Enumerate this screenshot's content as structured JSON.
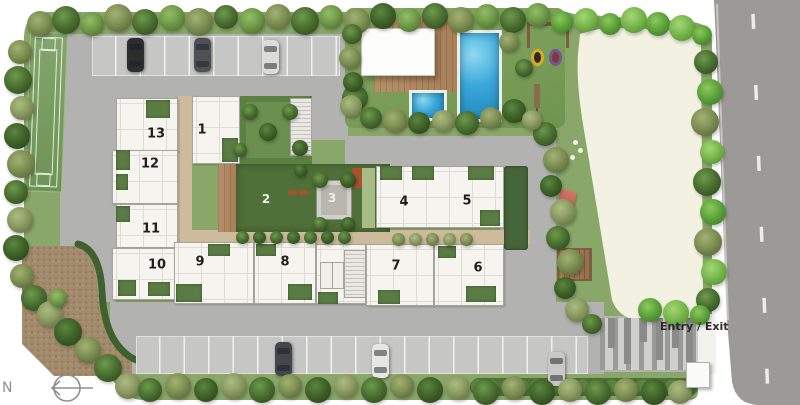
{
  "plan": {
    "entry_exit_label": "Entry / Exit",
    "north_label": "N",
    "units": [
      {
        "label": "1",
        "x": 202,
        "y": 130,
        "tone": "dark"
      },
      {
        "label": "2",
        "x": 266,
        "y": 199,
        "tone": "light"
      },
      {
        "label": "3",
        "x": 332,
        "y": 198,
        "tone": "light"
      },
      {
        "label": "4",
        "x": 404,
        "y": 202,
        "tone": "dark"
      },
      {
        "label": "5",
        "x": 467,
        "y": 201,
        "tone": "dark"
      },
      {
        "label": "6",
        "x": 478,
        "y": 268,
        "tone": "dark"
      },
      {
        "label": "7",
        "x": 396,
        "y": 266,
        "tone": "dark"
      },
      {
        "label": "8",
        "x": 285,
        "y": 262,
        "tone": "dark"
      },
      {
        "label": "9",
        "x": 200,
        "y": 262,
        "tone": "dark"
      },
      {
        "label": "10",
        "x": 157,
        "y": 265,
        "tone": "dark"
      },
      {
        "label": "11",
        "x": 151,
        "y": 229,
        "tone": "dark"
      },
      {
        "label": "12",
        "x": 150,
        "y": 164,
        "tone": "dark"
      },
      {
        "label": "13",
        "x": 156,
        "y": 134,
        "tone": "dark"
      }
    ],
    "colors": {
      "road": "#b2b3b0",
      "parking": "#c6c7c4",
      "stall": "#f0f0ee",
      "bld": "#f5f4ef",
      "bldline": "#a5a49e",
      "ugreen": "#5a7c44",
      "cgreen": "#4f7038",
      "lawn": "#8aa76a",
      "pool": "#2a9fd4",
      "wood": "#b18a63",
      "open": "#f3f2e2",
      "hwy": "#9c9a97",
      "gravel": "#a28b6c",
      "tan": "#cdbb9b",
      "labelDark": "#1e1e1c",
      "labelLight": "#edeee4"
    }
  }
}
